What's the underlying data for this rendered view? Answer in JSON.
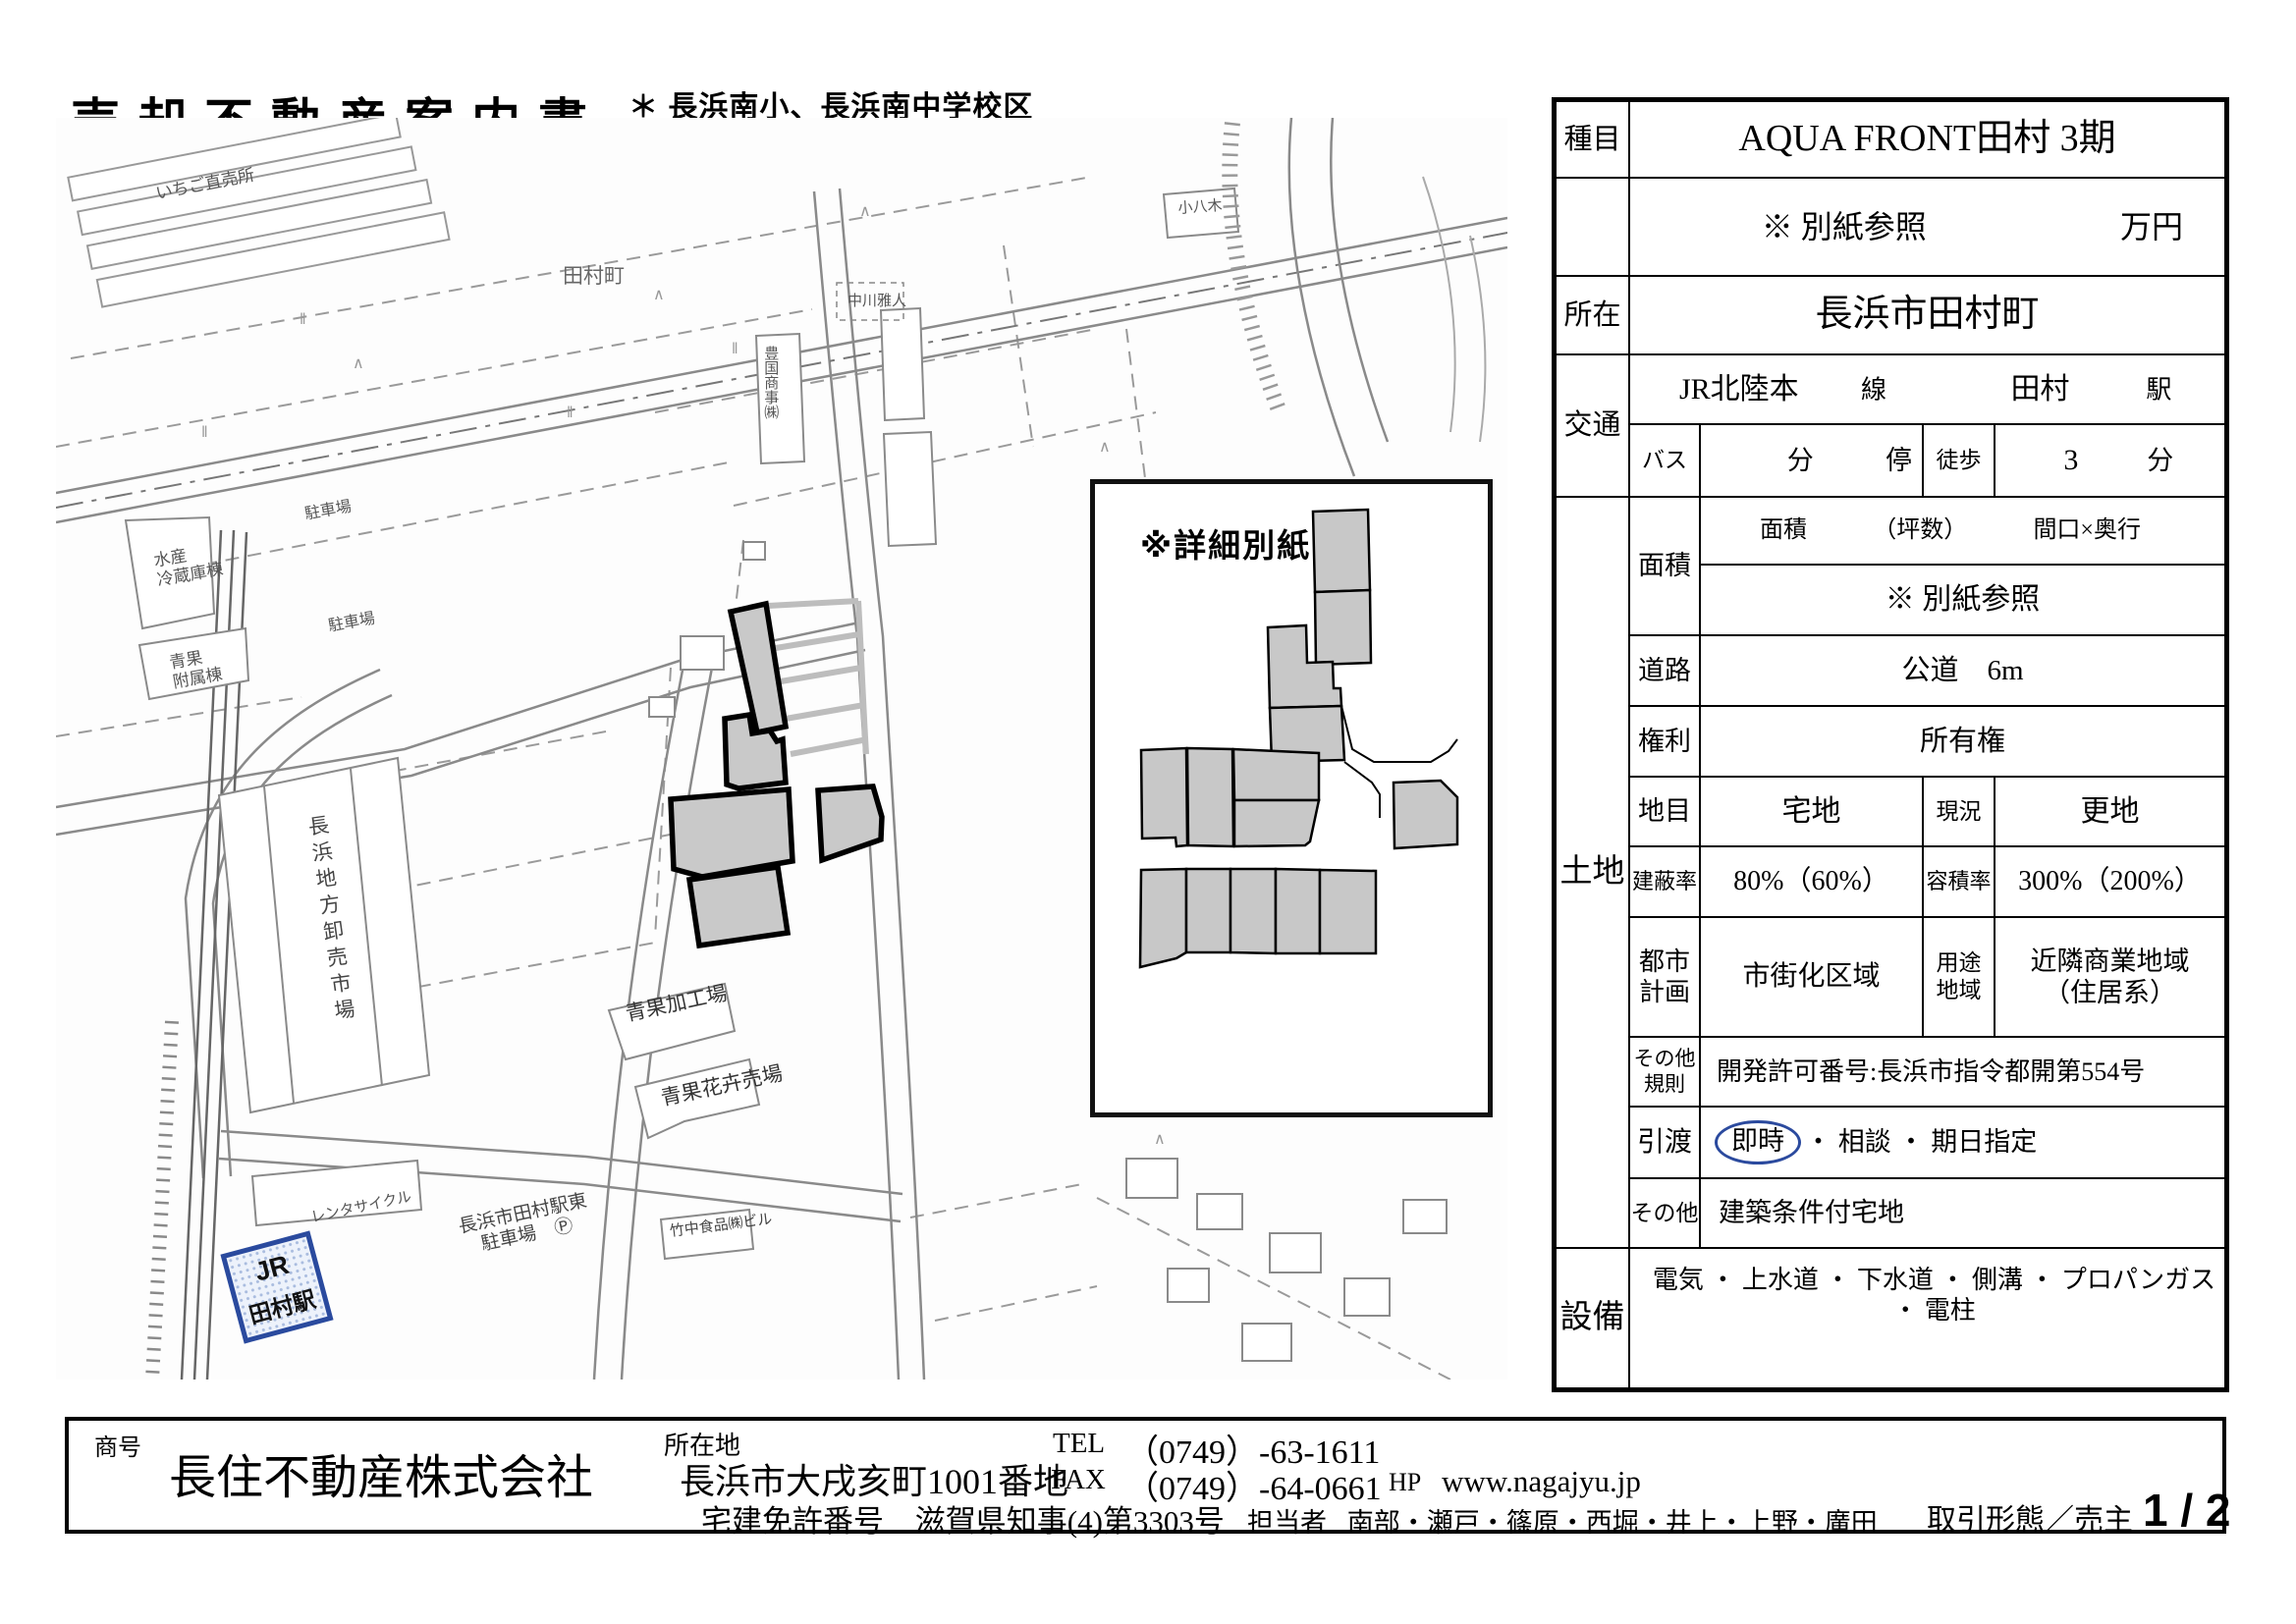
{
  "header": {
    "title": "売却不動産案内書",
    "note1": "＊ 長浜南小、長浜南中学校区",
    "note2": "＊ ＪＲ田村駅至近",
    "note3": "＊ 建築条件付"
  },
  "spec": {
    "type_label": "種目",
    "name": "AQUA FRONT田村 3期",
    "price_value": "※ 別紙参照",
    "price_unit": "万円",
    "location_label": "所在",
    "location": "長浜市田村町",
    "access_label": "交通",
    "rail_line": "JR北陸本",
    "rail_line_unit": "線",
    "rail_station": "田村",
    "rail_station_unit": "駅",
    "bus_label": "バス",
    "bus_min_unit": "分",
    "bus_stop_unit": "停",
    "walk_label": "徒歩",
    "walk_min": "3",
    "walk_unit": "分",
    "land_label": "土地",
    "area_label": "面積",
    "area_h_menseki": "面積",
    "area_h_tsubo": "（坪数）",
    "area_h_maguchi": "間口×奥行",
    "area_value": "※ 別紙参照",
    "road_label": "道路",
    "road_value": "公道　6m",
    "rights_label": "権利",
    "rights_value": "所有権",
    "category_label": "地目",
    "category_value": "宅地",
    "current_label": "現況",
    "current_value": "更地",
    "coverage_label": "建蔽率",
    "coverage_value": "80%（60%）",
    "far_label": "容積率",
    "far_value": "300%（200%）",
    "city_label_1": "都市",
    "city_label_2": "計画",
    "city_value": "市街化区域",
    "zoning_label_1": "用途",
    "zoning_label_2": "地域",
    "zoning_value_1": "近隣商業地域",
    "zoning_value_2": "（住居系）",
    "other_rule_label_1": "その他",
    "other_rule_label_2": "規則",
    "other_rule_value": "開発許可番号:長浜市指令都開第554号",
    "handover_label": "引渡",
    "handover_first": "即時",
    "handover_rest": "・ 相談 ・ 期日指定",
    "other_label": "その他",
    "other_value": "建築条件付宅地",
    "utilities_label": "設備",
    "utilities_value": "電気 ・ 上水道 ・ 下水道 ・ 側溝 ・ プロパンガス ・ 電柱"
  },
  "map": {
    "station_line": "JR",
    "station_name": "田村駅",
    "labels": {
      "ichigo": "いちご直売所",
      "tamuracho": "田村町",
      "toyokuni": "豊国商事㈱",
      "nakagawa": "中川雅人",
      "koyagi": "小八木",
      "suisan1": "水産",
      "suisan2": "冷蔵庫棟",
      "fuzoku1": "青果",
      "fuzoku2": "附属棟",
      "parking": "駐車場",
      "market": "長浜地方卸売市場",
      "kako": "青果加工場",
      "kaki": "青果花卉売場",
      "takenaka": "竹中食品㈱ビル",
      "rental": "レンタサイクル",
      "eki_parking1": "長浜市田村駅東",
      "eki_parking2": "駐車場　Ⓟ"
    }
  },
  "inset": {
    "note": "※詳細別紙"
  },
  "footer": {
    "trade_name_label": "商号",
    "company": "長住不動産株式会社",
    "address_label": "所在地",
    "address": "長浜市大戌亥町1001番地",
    "license_label": "宅建免許番号",
    "license": "滋賀県知事(4)第3303号",
    "tel_label": "TEL",
    "tel": "（0749）-63-1611",
    "fax_label": "FAX",
    "fax": "（0749）-64-0661",
    "hp_label": "HP",
    "hp": "www.nagajyu.jp",
    "staff_label": "担当者",
    "staff": "南部・瀬戸・篠原・西堀・井上・上野・廣田",
    "transaction": "取引形態／売主",
    "page": "1 / 2"
  },
  "colors": {
    "station_blue": "#2a4a9e",
    "handover_circle_blue": "#2b4a9e",
    "subject_lot_gray": "#c9c9c9",
    "line_black": "#000000"
  }
}
